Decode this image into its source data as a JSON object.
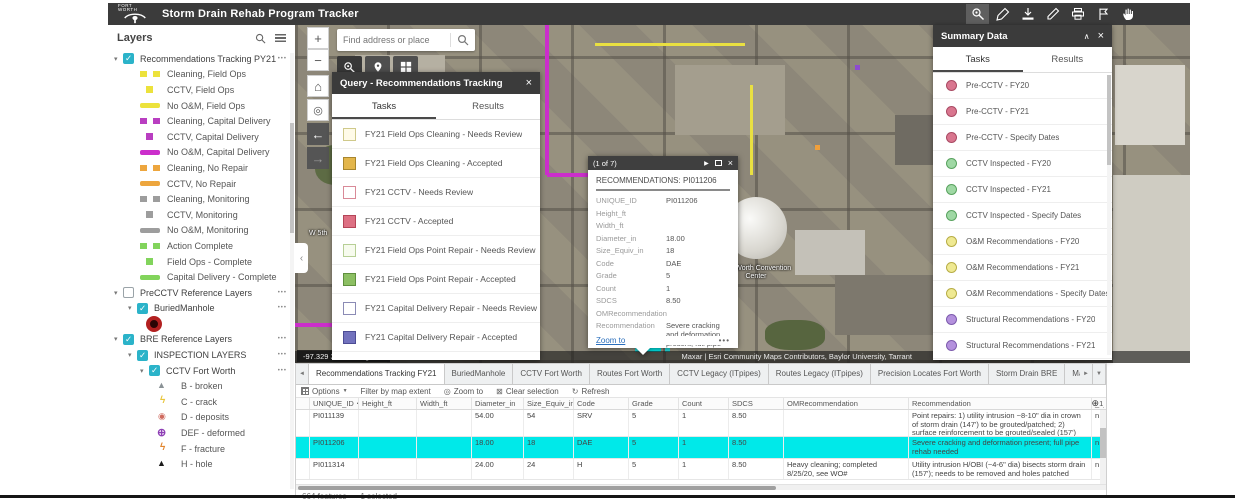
{
  "header": {
    "logo_text": "FORT WORTH",
    "title": "Storm Drain Rehab Program Tracker",
    "tools": [
      "query",
      "draw",
      "add-data",
      "edit",
      "print",
      "bookmark",
      "pan"
    ]
  },
  "layers_panel": {
    "title": "Layers",
    "items": [
      {
        "label": "Recommendations Tracking PY21",
        "kind": "group",
        "caret": "open",
        "check": "on",
        "menu": "yes",
        "pad": "6px"
      },
      {
        "label": "Cleaning, Field Ops",
        "kind": "legend",
        "swatch": "dash",
        "color": "#ece23c",
        "pad": "32px"
      },
      {
        "label": "CCTV, Field Ops",
        "kind": "legend",
        "swatch": "sq",
        "color": "#ece23c",
        "pad": "32px"
      },
      {
        "label": "No O&M, Field Ops",
        "kind": "legend",
        "swatch": "line",
        "color": "#ece23c",
        "pad": "32px"
      },
      {
        "label": "Cleaning, Capital Delivery",
        "kind": "legend",
        "swatch": "dash",
        "color": "#b93ec1",
        "pad": "32px"
      },
      {
        "label": "CCTV, Capital Delivery",
        "kind": "legend",
        "swatch": "sq",
        "color": "#b93ec1",
        "pad": "32px"
      },
      {
        "label": "No O&M, Capital Delivery",
        "kind": "legend",
        "swatch": "line",
        "color": "#cb2ecb",
        "pad": "32px"
      },
      {
        "label": "Cleaning, No Repair",
        "kind": "legend",
        "swatch": "dash",
        "color": "#eda63e",
        "pad": "32px"
      },
      {
        "label": "CCTV, No Repair",
        "kind": "legend",
        "swatch": "line",
        "color": "#eda63e",
        "pad": "32px"
      },
      {
        "label": "Cleaning, Monitoring",
        "kind": "legend",
        "swatch": "dash",
        "color": "#9d9d9d",
        "pad": "32px"
      },
      {
        "label": "CCTV, Monitoring",
        "kind": "legend",
        "swatch": "sq",
        "color": "#9d9d9d",
        "pad": "32px"
      },
      {
        "label": "No O&M, Monitoring",
        "kind": "legend",
        "swatch": "line",
        "color": "#9d9d9d",
        "pad": "32px"
      },
      {
        "label": "Action Complete",
        "kind": "legend",
        "swatch": "dash",
        "color": "#82d45c",
        "pad": "32px"
      },
      {
        "label": "Field Ops - Complete",
        "kind": "legend",
        "swatch": "sq",
        "color": "#82d45c",
        "pad": "32px"
      },
      {
        "label": "Capital Delivery - Complete",
        "kind": "legend",
        "swatch": "line",
        "color": "#82d45c",
        "pad": "32px"
      },
      {
        "label": "PreCCTV Reference Layers",
        "kind": "group",
        "caret": "open",
        "check": "off",
        "menu": "yes",
        "pad": "6px"
      },
      {
        "label": "BuriedManhole",
        "kind": "group",
        "caret": "open",
        "check": "on",
        "menu": "yes",
        "pad": "20px"
      },
      {
        "label": "",
        "kind": "legend",
        "swatch": "manhole",
        "color": "#b22020",
        "pad": "36px"
      },
      {
        "label": "BRE Reference Layers",
        "kind": "group",
        "caret": "open",
        "check": "on",
        "menu": "yes",
        "pad": "6px"
      },
      {
        "label": "INSPECTION LAYERS",
        "kind": "group",
        "caret": "open",
        "check": "on",
        "menu": "yes",
        "pad": "20px"
      },
      {
        "label": "CCTV Fort Worth",
        "kind": "group",
        "caret": "open",
        "check": "on",
        "menu": "yes",
        "pad": "32px"
      },
      {
        "label": "B - broken",
        "kind": "legend",
        "swatch": "tri",
        "color": "#8a9296",
        "pad": "46px"
      },
      {
        "label": "C - crack",
        "kind": "legend",
        "swatch": "zig",
        "color": "#e8c53b",
        "pad": "46px"
      },
      {
        "label": "D - deposits",
        "kind": "legend",
        "swatch": "dotring",
        "color": "#cf6a5e",
        "pad": "46px"
      },
      {
        "label": "DEF - deformed",
        "kind": "legend",
        "swatch": "globe",
        "color": "#8e3fb5",
        "pad": "46px"
      },
      {
        "label": "F - fracture",
        "kind": "legend",
        "swatch": "zig",
        "color": "#e2862f",
        "pad": "46px"
      },
      {
        "label": "H - hole",
        "kind": "legend",
        "swatch": "trisolid",
        "color": "#1a1a1a",
        "pad": "46px"
      }
    ]
  },
  "map": {
    "search_placeholder": "Find address or place",
    "coordinates": "-97.329 32.754 Degrees",
    "attribution": "Maxar | Esri Community Maps Contributors, Baylor University, Tarrant",
    "labels": {
      "convention_center": "Fort Worth Convention Center",
      "street": "W 5th"
    }
  },
  "query_panel": {
    "title": "Query - Recommendations Tracking",
    "close": "×",
    "tabs": {
      "tasks": "Tasks",
      "results": "Results"
    },
    "tasks": [
      {
        "label": "FY21 Field Ops Cleaning - Needs Review",
        "fill": "#fffbe8",
        "border": "#cfc98a"
      },
      {
        "label": "FY21 Field Ops Cleaning - Accepted",
        "fill": "#e3b64b",
        "border": "#a8862e"
      },
      {
        "label": "FY21 CCTV - Needs Review",
        "fill": "#ffffff",
        "border": "#d98a98"
      },
      {
        "label": "FY21 CCTV - Accepted",
        "fill": "#dd7083",
        "border": "#b44557"
      },
      {
        "label": "FY21 Field Ops Point Repair - Needs Review",
        "fill": "#f7fbee",
        "border": "#b7cf96"
      },
      {
        "label": "FY21 Field Ops Point Repair - Accepted",
        "fill": "#8cbf63",
        "border": "#5f8f3e"
      },
      {
        "label": "FY21 Capital Delivery Repair - Needs Review",
        "fill": "#ffffff",
        "border": "#8b8bb5"
      },
      {
        "label": "FY21 Capital Delivery Repair - Accepted",
        "fill": "#7272bd",
        "border": "#4c4c94"
      }
    ]
  },
  "popup": {
    "counter": "(1 of 7)",
    "title": "RECOMMENDATIONS: PI011206",
    "fields": [
      {
        "label": "UNIQUE_ID",
        "value": "PI011206"
      },
      {
        "label": "Height_ft",
        "value": ""
      },
      {
        "label": "Width_ft",
        "value": ""
      },
      {
        "label": "Diameter_in",
        "value": "18.00"
      },
      {
        "label": "Size_Equiv_in",
        "value": "18"
      },
      {
        "label": "Code",
        "value": "DAE"
      },
      {
        "label": "Grade",
        "value": "5"
      },
      {
        "label": "Count",
        "value": "1"
      },
      {
        "label": "SDCS",
        "value": "8.50"
      },
      {
        "label": "OMRecommendation",
        "value": ""
      },
      {
        "label": "Recommendation",
        "value": "Severe cracking and deformation present; full pipe rehab needed"
      }
    ],
    "zoom_link": "Zoom to",
    "more": "•••"
  },
  "summary_panel": {
    "title": "Summary Data",
    "collapse": "∧",
    "close": "×",
    "tabs": {
      "tasks": "Tasks",
      "results": "Results"
    },
    "tasks": [
      {
        "label": "Pre-CCTV - FY20",
        "fill": "#d9768f",
        "border": "#a94a63"
      },
      {
        "label": "Pre-CCTV - FY21",
        "fill": "#d9768f",
        "border": "#a94a63"
      },
      {
        "label": "Pre-CCTV - Specify Dates",
        "fill": "#d9768f",
        "border": "#a94a63"
      },
      {
        "label": "CCTV Inspected - FY20",
        "fill": "#9fd8a4",
        "border": "#59a35f"
      },
      {
        "label": "CCTV Inspected - FY21",
        "fill": "#9fd8a4",
        "border": "#59a35f"
      },
      {
        "label": "CCTV Inspected - Specify Dates",
        "fill": "#9fd8a4",
        "border": "#59a35f"
      },
      {
        "label": "O&M Recommendations - FY20",
        "fill": "#efe992",
        "border": "#b7ad46"
      },
      {
        "label": "O&M Recommendations - FY21",
        "fill": "#efe992",
        "border": "#b7ad46"
      },
      {
        "label": "O&M Recommendations - Specify Dates",
        "fill": "#efe992",
        "border": "#b7ad46"
      },
      {
        "label": "Structural Recommendations - FY20",
        "fill": "#b491dd",
        "border": "#7d5bad"
      },
      {
        "label": "Structural Recommendations - FY21",
        "fill": "#b491dd",
        "border": "#7d5bad"
      }
    ]
  },
  "attribute_table": {
    "tabs": [
      {
        "label": "Recommendations Tracking FY21",
        "state": "active"
      },
      {
        "label": "BuriedManhole",
        "state": ""
      },
      {
        "label": "CCTV Fort Worth",
        "state": ""
      },
      {
        "label": "Routes Fort Worth",
        "state": ""
      },
      {
        "label": "CCTV Legacy (ITpipes)",
        "state": ""
      },
      {
        "label": "Routes Legacy (ITpipes)",
        "state": ""
      },
      {
        "label": "Precision Locates Fort Worth",
        "state": ""
      },
      {
        "label": "Storm Drain BRE",
        "state": ""
      },
      {
        "label": "Mapshed BRE",
        "state": ""
      },
      {
        "label": "Failure_Events",
        "state": ""
      },
      {
        "label": "PIPES",
        "state": ""
      },
      {
        "label": "BLDG_FOOTPRINTS",
        "state": ""
      },
      {
        "label": "MAPSH",
        "state": ""
      }
    ],
    "toolbar": {
      "options": "Options",
      "filter": "Filter by map extent",
      "zoom_to": "Zoom to",
      "clear": "Clear selection",
      "refresh": "Refresh"
    },
    "columns": [
      {
        "label": "",
        "sort": ""
      },
      {
        "label": "UNIQUE_ID",
        "sort": "▲"
      },
      {
        "label": "Height_ft",
        "sort": ""
      },
      {
        "label": "Width_ft",
        "sort": ""
      },
      {
        "label": "Diameter_in",
        "sort": ""
      },
      {
        "label": "Size_Equiv_in",
        "sort": ""
      },
      {
        "label": "Code",
        "sort": ""
      },
      {
        "label": "Grade",
        "sort": ""
      },
      {
        "label": "Count",
        "sort": ""
      },
      {
        "label": "SDCS",
        "sort": ""
      },
      {
        "label": "OMRecommendation",
        "sort": ""
      },
      {
        "label": "Recommendation",
        "sort": ""
      },
      {
        "label": "_1_Cleaning",
        "sort": ""
      }
    ],
    "rows": [
      {
        "state": "",
        "cells": [
          "",
          "PI011139",
          "",
          "",
          "54.00",
          "54",
          "SRV",
          "5",
          "1",
          "8.50",
          "",
          "Point repairs: 1) utility intrusion ~8-10\" dia in crown of storm drain (147') to be grouted/patched; 2) surface reinforcement to be grouted/sealed (157')",
          "n"
        ]
      },
      {
        "state": "selected",
        "cells": [
          "",
          "PI011206",
          "",
          "",
          "18.00",
          "18",
          "DAE",
          "5",
          "1",
          "8.50",
          "",
          "Severe cracking and deformation present; full pipe rehab needed",
          "n"
        ]
      },
      {
        "state": "",
        "cells": [
          "",
          "PI011314",
          "",
          "",
          "24.00",
          "24",
          "H",
          "5",
          "1",
          "8.50",
          "Heavy cleaning; completed 8/25/20, see WO#",
          "Utility intrusion H/OBI (~4-6\" dia) bisects storm drain (157'); needs to be removed and holes patched",
          "n"
        ]
      }
    ],
    "status": {
      "features": "664 features",
      "selected": "1 selected"
    }
  }
}
